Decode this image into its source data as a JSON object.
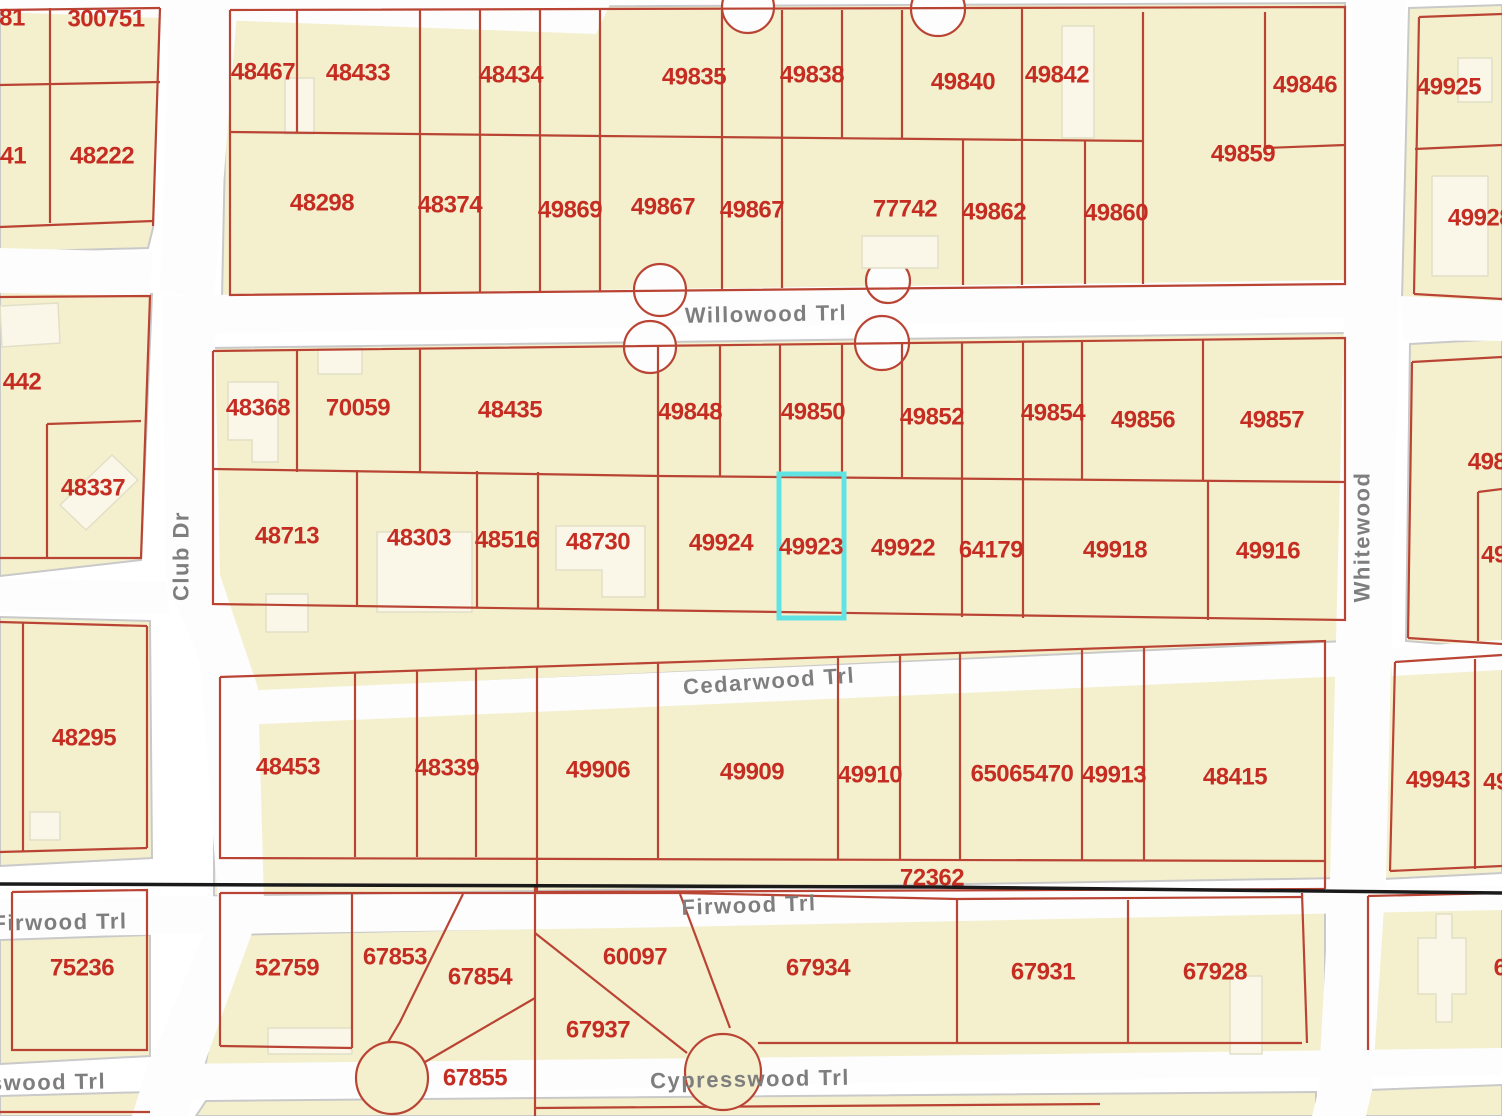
{
  "map": {
    "width": 1502,
    "height": 1116,
    "selected_parcel_id": "49923",
    "colors": {
      "background": "#ffffff",
      "block": "#f4f0ce",
      "block_edge": "#c9c9c9",
      "street": "#fdfdfd",
      "building": "#faf7e8",
      "building_edge": "#e2dfc6",
      "parcel_line": "#ba4434",
      "parcel_label": "#c52d23",
      "street_label": "#7e7e7e",
      "black_line": "#1a1a1a",
      "highlight": "#62e3e3"
    },
    "blocks": [
      {
        "pts": "0,6 160,6 153,228 148,248 0,252"
      },
      {
        "pts": "228,8 1345,3 1345,287 222,298"
      },
      {
        "pts": "0,292 152,294 141,560 0,576"
      },
      {
        "pts": "210,348 1345,333 1345,641 215,694"
      },
      {
        "pts": "1410,344 1502,339 1502,649 1406,641"
      },
      {
        "pts": "1409,8 1502,5 1502,303 1402,299"
      },
      {
        "pts": "0,617 150,621 152,858 0,866"
      },
      {
        "pts": "214,698 1345,646 1345,878 214,896"
      },
      {
        "pts": "1388,651 1502,644 1502,873 1384,879"
      },
      {
        "pts": "0,940 150,935 150,1056 0,1064"
      },
      {
        "pts": "228,935 620,926 957,910 1325,903 1325,1054 900,1058 205,1068"
      },
      {
        "pts": "1366,902 1502,896 1502,1050 1371,1056"
      },
      {
        "pts": "0,1096 148,1092 140,1116 0,1116"
      },
      {
        "pts": "206,1101 535,1098 535,1116 196,1116"
      },
      {
        "pts": "535,1098 1316,1092 1316,1116 535,1116"
      },
      {
        "pts": "1368,1090 1502,1085 1502,1116 1362,1116"
      }
    ],
    "streets": [
      {
        "name": "top-left-road",
        "pts": "0,0 612,0 596,34 0,12"
      },
      {
        "name": "club-dr-upper",
        "pts": "170,0 238,0 214,298 160,293"
      },
      {
        "name": "willowood-left",
        "pts": "0,248 152,252 150,296 0,293"
      },
      {
        "name": "willowood-main",
        "pts": "208,295 1350,280 1350,318 212,333"
      },
      {
        "name": "willowood-right",
        "pts": "1400,296 1502,301 1502,341 1404,340"
      },
      {
        "name": "club-dr-mid",
        "pts": "162,295 214,298 220,575 258,688 264,902 218,902 200,662 166,578"
      },
      {
        "name": "club-dr-lower",
        "pts": "218,900 264,900 205,1062 150,1062"
      },
      {
        "name": "club-dr-bottom",
        "pts": "205,1058 150,1058 132,1116 188,1116"
      },
      {
        "name": "cedarwood-left",
        "pts": "0,578 166,582 170,614 0,612"
      },
      {
        "name": "cedarwood-main",
        "pts": "214,692 1348,643 1348,676 216,726"
      },
      {
        "name": "cedarwood-right",
        "pts": "1390,648 1502,640 1502,670 1392,676"
      },
      {
        "name": "whitewood-upper",
        "pts": "1352,0 1406,0 1386,880 1330,882"
      },
      {
        "name": "whitewood-lower",
        "pts": "1330,878 1386,876 1372,1092 1318,1095"
      },
      {
        "name": "whitewood-bottom",
        "pts": "1318,1092 1372,1090 1366,1116 1312,1116"
      },
      {
        "name": "firwood-main",
        "pts": "0,898 1502,886 1502,910 620,928 0,937"
      },
      {
        "name": "cypresswood-main",
        "pts": "170,1064 900,1056 1502,1048 1502,1075 900,1082 150,1100"
      }
    ],
    "notches": [
      {
        "cx": 748,
        "cy": 7,
        "r": 26
      },
      {
        "cx": 938,
        "cy": 9,
        "r": 27
      },
      {
        "cx": 660,
        "cy": 290,
        "r": 26
      },
      {
        "cx": 888,
        "cy": 281,
        "r": 22
      },
      {
        "cx": 650,
        "cy": 347,
        "r": 26
      },
      {
        "cx": 882,
        "cy": 343,
        "r": 27
      }
    ],
    "buildings": [
      {
        "pts": "285,78 314,78 314,134 285,134"
      },
      {
        "pts": "0,306 58,303 60,343 2,347"
      },
      {
        "pts": "60,505 112,455 138,480 86,530"
      },
      {
        "pts": "318,348 362,348 362,374 318,374"
      },
      {
        "pts": "228,382 278,382 278,462 252,462 252,440 228,440"
      },
      {
        "pts": "266,594 308,594 308,632 266,632"
      },
      {
        "pts": "377,532 472,532 472,612 377,612"
      },
      {
        "pts": "556,526 645,526 645,597 602,597 602,570 556,570"
      },
      {
        "pts": "862,236 938,236 938,268 862,268"
      },
      {
        "pts": "1062,26 1094,26 1094,138 1062,138"
      },
      {
        "pts": "1458,58 1492,58 1492,102 1458,102"
      },
      {
        "pts": "1432,176 1488,176 1488,276 1432,276"
      },
      {
        "pts": "30,812 60,812 60,840 30,840"
      },
      {
        "pts": "268,1028 352,1028 352,1054 268,1054"
      },
      {
        "pts": "1230,976 1262,976 1262,1054 1230,1054"
      },
      {
        "pts": "1418,938 1436,938 1436,914 1452,914 1452,938 1466,938 1466,994 1452,994 1452,1022 1436,1022 1436,994 1418,994"
      }
    ],
    "red_lines": [
      {
        "pts": "0,10 160,8"
      },
      {
        "pts": "50,8 50,223"
      },
      {
        "pts": "0,85 160,82"
      },
      {
        "pts": "160,8 153,226"
      },
      {
        "pts": "0,227 153,221"
      },
      {
        "pts": "230,10 1345,7 1345,284 230,295 230,10"
      },
      {
        "pts": "297,10 297,133"
      },
      {
        "pts": "420,9 420,293"
      },
      {
        "pts": "480,9 480,292"
      },
      {
        "pts": "540,9 540,292"
      },
      {
        "pts": "600,9 600,291"
      },
      {
        "pts": "722,10 722,289"
      },
      {
        "pts": "782,10 782,288"
      },
      {
        "pts": "842,10 842,139"
      },
      {
        "pts": "902,10 902,139"
      },
      {
        "pts": "963,140 963,285"
      },
      {
        "pts": "1022,9 1022,285"
      },
      {
        "pts": "1085,140 1085,284"
      },
      {
        "pts": "1143,12 1143,284"
      },
      {
        "pts": "1265,12 1265,148"
      },
      {
        "pts": "1265,148 1345,145"
      },
      {
        "pts": "230,132 600,136 1143,141"
      },
      {
        "pts": "0,297 150,296 141,558 0,558"
      },
      {
        "pts": "47,424 141,421"
      },
      {
        "pts": "47,424 47,558"
      },
      {
        "pts": "213,351 1345,338 1345,620 213,604 213,351"
      },
      {
        "pts": "213,469 660,476 1345,482"
      },
      {
        "pts": "297,350 297,472"
      },
      {
        "pts": "420,349 420,473"
      },
      {
        "pts": "658,346 658,476"
      },
      {
        "pts": "720,345 720,477"
      },
      {
        "pts": "780,344 780,477"
      },
      {
        "pts": "842,343 842,478"
      },
      {
        "pts": "902,343 902,478"
      },
      {
        "pts": "962,342 962,479"
      },
      {
        "pts": "1023,341 1023,479"
      },
      {
        "pts": "1082,341 1082,480"
      },
      {
        "pts": "1203,339 1203,481"
      },
      {
        "pts": "357,470 357,606"
      },
      {
        "pts": "477,471 477,608"
      },
      {
        "pts": "538,472 538,609"
      },
      {
        "pts": "658,476 658,611"
      },
      {
        "pts": "962,479 962,617"
      },
      {
        "pts": "1023,479 1023,618"
      },
      {
        "pts": "1208,481 1208,620"
      },
      {
        "pts": "1412,362 1502,357"
      },
      {
        "pts": "1412,362 1408,638"
      },
      {
        "pts": "1408,638 1502,644"
      },
      {
        "pts": "1478,492 1502,489"
      },
      {
        "pts": "1478,492 1478,641"
      },
      {
        "pts": "1419,17 1502,14"
      },
      {
        "pts": "1419,17 1414,294"
      },
      {
        "pts": "1415,149 1502,145"
      },
      {
        "pts": "1414,294 1502,299"
      },
      {
        "pts": "0,622 147,626"
      },
      {
        "pts": "147,626 147,848"
      },
      {
        "pts": "0,852 147,848"
      },
      {
        "pts": "23,622 23,851"
      },
      {
        "pts": "220,677 1325,641 1325,861 220,858 220,677"
      },
      {
        "pts": "355,673 355,857"
      },
      {
        "pts": "417,671 417,857"
      },
      {
        "pts": "476,669 476,857"
      },
      {
        "pts": "537,667 537,892"
      },
      {
        "pts": "658,663 658,858"
      },
      {
        "pts": "838,657 838,859"
      },
      {
        "pts": "900,655 900,860"
      },
      {
        "pts": "960,653 960,860"
      },
      {
        "pts": "1082,649 1082,861"
      },
      {
        "pts": "1144,647 1144,861"
      },
      {
        "pts": "537,892 1325,889"
      },
      {
        "pts": "1325,861 1325,889"
      },
      {
        "pts": "1395,662 1502,655"
      },
      {
        "pts": "1395,662 1390,871"
      },
      {
        "pts": "1390,871 1502,866"
      },
      {
        "pts": "1475,659 1475,869"
      },
      {
        "pts": "12,892 147,890 147,1050 12,1050 12,892"
      },
      {
        "pts": "220,893 680,893 957,899 1302,897"
      },
      {
        "pts": "352,893 352,1048"
      },
      {
        "pts": "220,893 220,1046"
      },
      {
        "pts": "220,1046 352,1048"
      },
      {
        "pts": "463,894 400,1022 387,1044"
      },
      {
        "pts": "535,998 413,1069"
      },
      {
        "pts": "535,884 535,1116"
      },
      {
        "pts": "535,933 687,1053"
      },
      {
        "pts": "680,894 730,1028"
      },
      {
        "pts": "758,1043 1302,1043"
      },
      {
        "pts": "957,900 957,1043"
      },
      {
        "pts": "1128,900 1128,1043"
      },
      {
        "pts": "1302,893 1307,1043"
      },
      {
        "pts": "1368,896 1368,1050"
      },
      {
        "pts": "1368,896 1502,893"
      },
      {
        "pts": "535,1108 1100,1104"
      },
      {
        "pts": "0,1112 150,1112"
      }
    ],
    "red_circles": [
      {
        "cx": 392,
        "cy": 1078,
        "r": 36
      },
      {
        "cx": 723,
        "cy": 1072,
        "r": 38
      }
    ],
    "black_line": {
      "pts": "0,884 932,887 1502,893"
    },
    "highlight": {
      "x": 779,
      "y": 474,
      "w": 65,
      "h": 144
    },
    "parcel_labels": [
      {
        "t": "81",
        "x": 12,
        "y": 18
      },
      {
        "t": "300751",
        "x": 106,
        "y": 19
      },
      {
        "t": "48441",
        "x": -6,
        "y": 156
      },
      {
        "t": "48222",
        "x": 102,
        "y": 156
      },
      {
        "t": "48467",
        "x": 263,
        "y": 72
      },
      {
        "t": "48433",
        "x": 358,
        "y": 73
      },
      {
        "t": "48434",
        "x": 511,
        "y": 75
      },
      {
        "t": "49835",
        "x": 694,
        "y": 77
      },
      {
        "t": "49838",
        "x": 812,
        "y": 75
      },
      {
        "t": "49840",
        "x": 963,
        "y": 82
      },
      {
        "t": "49842",
        "x": 1057,
        "y": 75
      },
      {
        "t": "49846",
        "x": 1305,
        "y": 85
      },
      {
        "t": "49859",
        "x": 1243,
        "y": 154
      },
      {
        "t": "48298",
        "x": 322,
        "y": 203
      },
      {
        "t": "48374",
        "x": 450,
        "y": 205
      },
      {
        "t": "49869",
        "x": 570,
        "y": 210
      },
      {
        "t": "49867",
        "x": 663,
        "y": 207
      },
      {
        "t": "49867",
        "x": 752,
        "y": 210
      },
      {
        "t": "77742",
        "x": 905,
        "y": 209
      },
      {
        "t": "49862",
        "x": 994,
        "y": 212
      },
      {
        "t": "49860",
        "x": 1116,
        "y": 213
      },
      {
        "t": "49925",
        "x": 1449,
        "y": 87
      },
      {
        "t": "49928",
        "x": 1480,
        "y": 218
      },
      {
        "t": "442",
        "x": 22,
        "y": 382
      },
      {
        "t": "48337",
        "x": 93,
        "y": 488
      },
      {
        "t": "48368",
        "x": 258,
        "y": 408
      },
      {
        "t": "70059",
        "x": 358,
        "y": 408
      },
      {
        "t": "48435",
        "x": 510,
        "y": 410
      },
      {
        "t": "49848",
        "x": 690,
        "y": 412
      },
      {
        "t": "49850",
        "x": 813,
        "y": 412
      },
      {
        "t": "49852",
        "x": 932,
        "y": 417
      },
      {
        "t": "49854",
        "x": 1053,
        "y": 413
      },
      {
        "t": "49856",
        "x": 1143,
        "y": 420
      },
      {
        "t": "49857",
        "x": 1272,
        "y": 420
      },
      {
        "t": "48713",
        "x": 287,
        "y": 536
      },
      {
        "t": "48303",
        "x": 419,
        "y": 538
      },
      {
        "t": "48516",
        "x": 507,
        "y": 540
      },
      {
        "t": "48730",
        "x": 598,
        "y": 542
      },
      {
        "t": "49924",
        "x": 721,
        "y": 543
      },
      {
        "t": "49923",
        "x": 811,
        "y": 547
      },
      {
        "t": "49922",
        "x": 903,
        "y": 548
      },
      {
        "t": "64179",
        "x": 991,
        "y": 550
      },
      {
        "t": "49918",
        "x": 1115,
        "y": 550
      },
      {
        "t": "49916",
        "x": 1268,
        "y": 551
      },
      {
        "t": "498",
        "x": 1487,
        "y": 462
      },
      {
        "t": "49",
        "x": 1494,
        "y": 555
      },
      {
        "t": "48295",
        "x": 84,
        "y": 738
      },
      {
        "t": "48453",
        "x": 288,
        "y": 767
      },
      {
        "t": "48339",
        "x": 447,
        "y": 768
      },
      {
        "t": "49906",
        "x": 598,
        "y": 770
      },
      {
        "t": "49909",
        "x": 752,
        "y": 772
      },
      {
        "t": "49910",
        "x": 870,
        "y": 775
      },
      {
        "t": "65065470",
        "x": 1022,
        "y": 774
      },
      {
        "t": "49913",
        "x": 1114,
        "y": 775
      },
      {
        "t": "48415",
        "x": 1235,
        "y": 777
      },
      {
        "t": "72362",
        "x": 932,
        "y": 878
      },
      {
        "t": "49943",
        "x": 1438,
        "y": 780
      },
      {
        "t": "49",
        "x": 1496,
        "y": 782
      },
      {
        "t": "75236",
        "x": 82,
        "y": 968
      },
      {
        "t": "52759",
        "x": 287,
        "y": 968
      },
      {
        "t": "67853",
        "x": 395,
        "y": 957
      },
      {
        "t": "67854",
        "x": 480,
        "y": 977
      },
      {
        "t": "60097",
        "x": 635,
        "y": 957
      },
      {
        "t": "67934",
        "x": 818,
        "y": 968
      },
      {
        "t": "67931",
        "x": 1043,
        "y": 972
      },
      {
        "t": "67928",
        "x": 1215,
        "y": 972
      },
      {
        "t": "67937",
        "x": 598,
        "y": 1030
      },
      {
        "t": "67855",
        "x": 475,
        "y": 1078
      },
      {
        "t": "6",
        "x": 1500,
        "y": 968
      }
    ],
    "street_labels": [
      {
        "t": "Willowood Trl",
        "x": 766,
        "y": 314,
        "rot": -1
      },
      {
        "t": "Club Dr",
        "x": 181,
        "y": 556,
        "rot": -90
      },
      {
        "t": "Whitewood",
        "x": 1362,
        "y": 537,
        "rot": -90
      },
      {
        "t": "Cedarwood Trl",
        "x": 769,
        "y": 681,
        "rot": -4
      },
      {
        "t": "Firwood Trl",
        "x": 60,
        "y": 922,
        "rot": -1
      },
      {
        "t": "Firwood Trl",
        "x": 749,
        "y": 905,
        "rot": -2
      },
      {
        "t": "Cypresswood Trl",
        "x": 750,
        "y": 1079,
        "rot": -1
      },
      {
        "t": "swood Trl",
        "x": 48,
        "y": 1082,
        "rot": -1
      }
    ]
  }
}
